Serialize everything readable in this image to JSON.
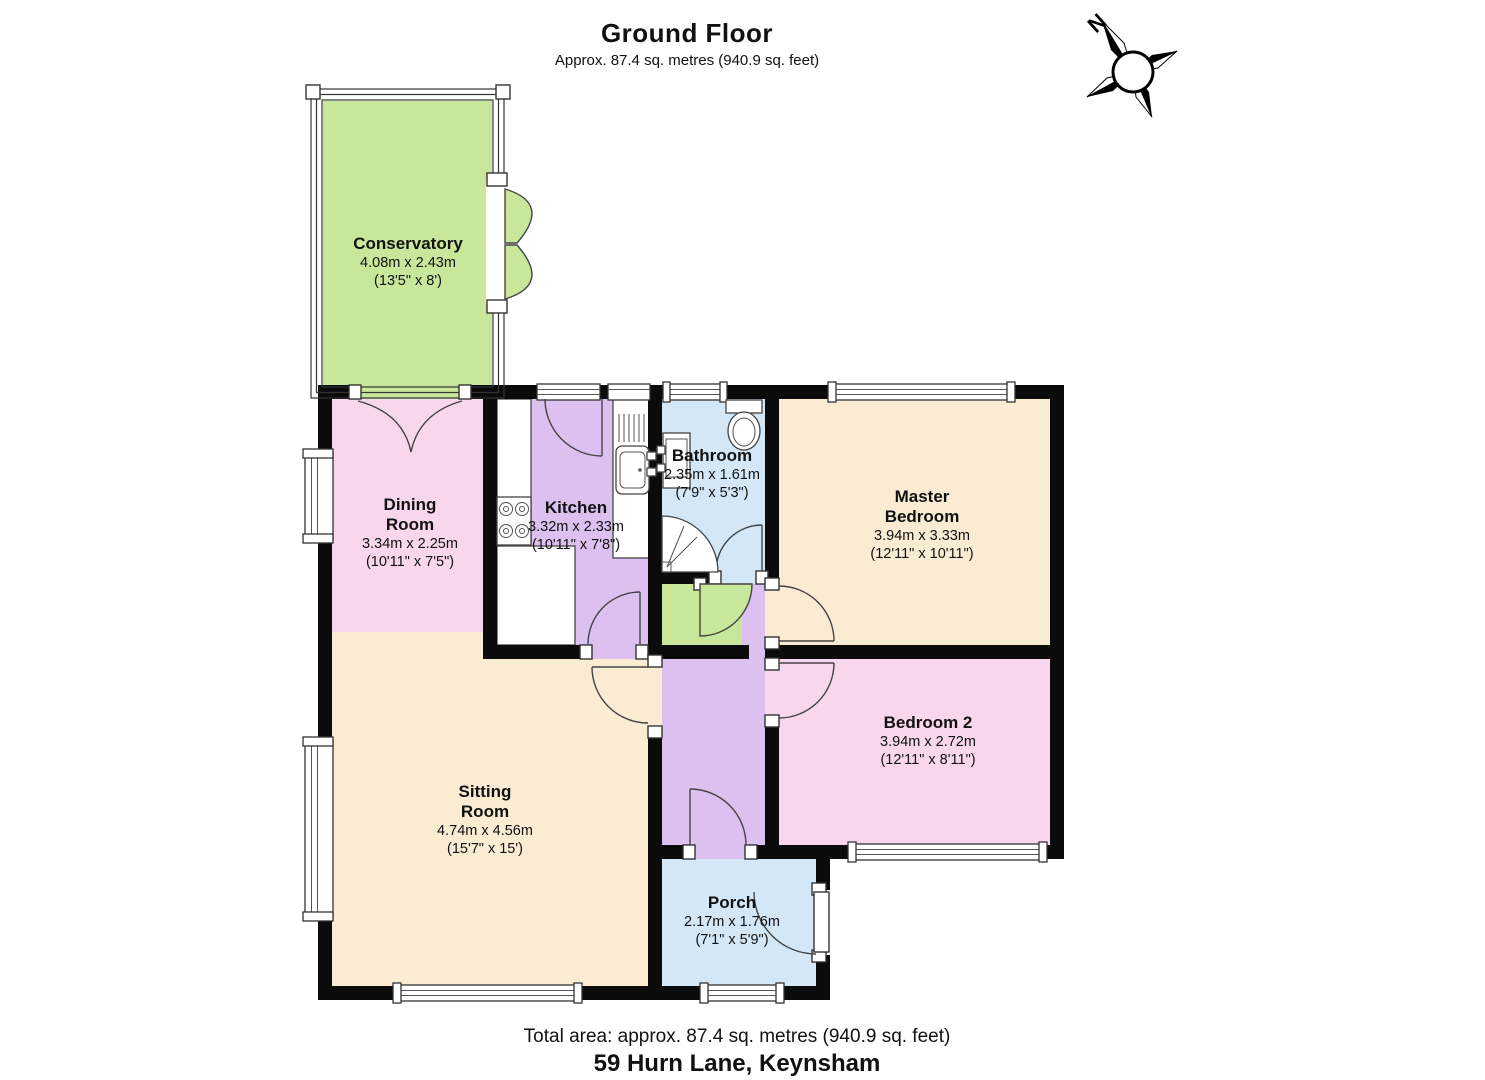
{
  "header": {
    "title": "Ground Floor",
    "subtitle": "Approx. 87.4 sq. metres (940.9 sq. feet)"
  },
  "compass": {
    "label": "N"
  },
  "colors": {
    "wall": "#0b0b0b",
    "green": "#c9e79a",
    "pink": "#f8d7ee",
    "purple": "#dcc0f0",
    "blue": "#d3e7f7",
    "cream": "#faecd3"
  },
  "rooms": [
    {
      "id": "conservatory",
      "name": "Conservatory",
      "dimensions_metric": "4.08m x 2.43m",
      "dimensions_imperial": "(13'5\" x 8')",
      "color": "#c9e79a"
    },
    {
      "id": "dining-room",
      "name": "Dining Room",
      "dimensions_metric": "3.34m x 2.25m",
      "dimensions_imperial": "(10'11\" x 7'5\")",
      "color": "#f8d7ee"
    },
    {
      "id": "kitchen",
      "name": "Kitchen",
      "dimensions_metric": "3.32m x 2.33m",
      "dimensions_imperial": "(10'11\" x 7'8\")",
      "color": "#dcc0f0"
    },
    {
      "id": "bathroom",
      "name": "Bathroom",
      "dimensions_metric": "2.35m x 1.61m",
      "dimensions_imperial": "(7'9\" x 5'3\")",
      "color": "#d3e7f7"
    },
    {
      "id": "master-bedroom",
      "name": "Master Bedroom",
      "dimensions_metric": "3.94m x 3.33m",
      "dimensions_imperial": "(12'11\" x 10'11\")",
      "color": "#faecd3"
    },
    {
      "id": "bedroom-2",
      "name": "Bedroom 2",
      "dimensions_metric": "3.94m x 2.72m",
      "dimensions_imperial": "(12'11\" x 8'11\")",
      "color": "#f8d7ee"
    },
    {
      "id": "sitting-room",
      "name": "Sitting Room",
      "dimensions_metric": "4.74m x 4.56m",
      "dimensions_imperial": "(15'7\" x 15')",
      "color": "#faecd3"
    },
    {
      "id": "porch",
      "name": "Porch",
      "dimensions_metric": "2.17m x 1.76m",
      "dimensions_imperial": "(7'1\" x 5'9\")",
      "color": "#d3e7f7"
    }
  ],
  "footer": {
    "total_area": "Total area: approx. 87.4 sq. metres (940.9 sq. feet)",
    "address": "59 Hurn Lane, Keynsham"
  }
}
